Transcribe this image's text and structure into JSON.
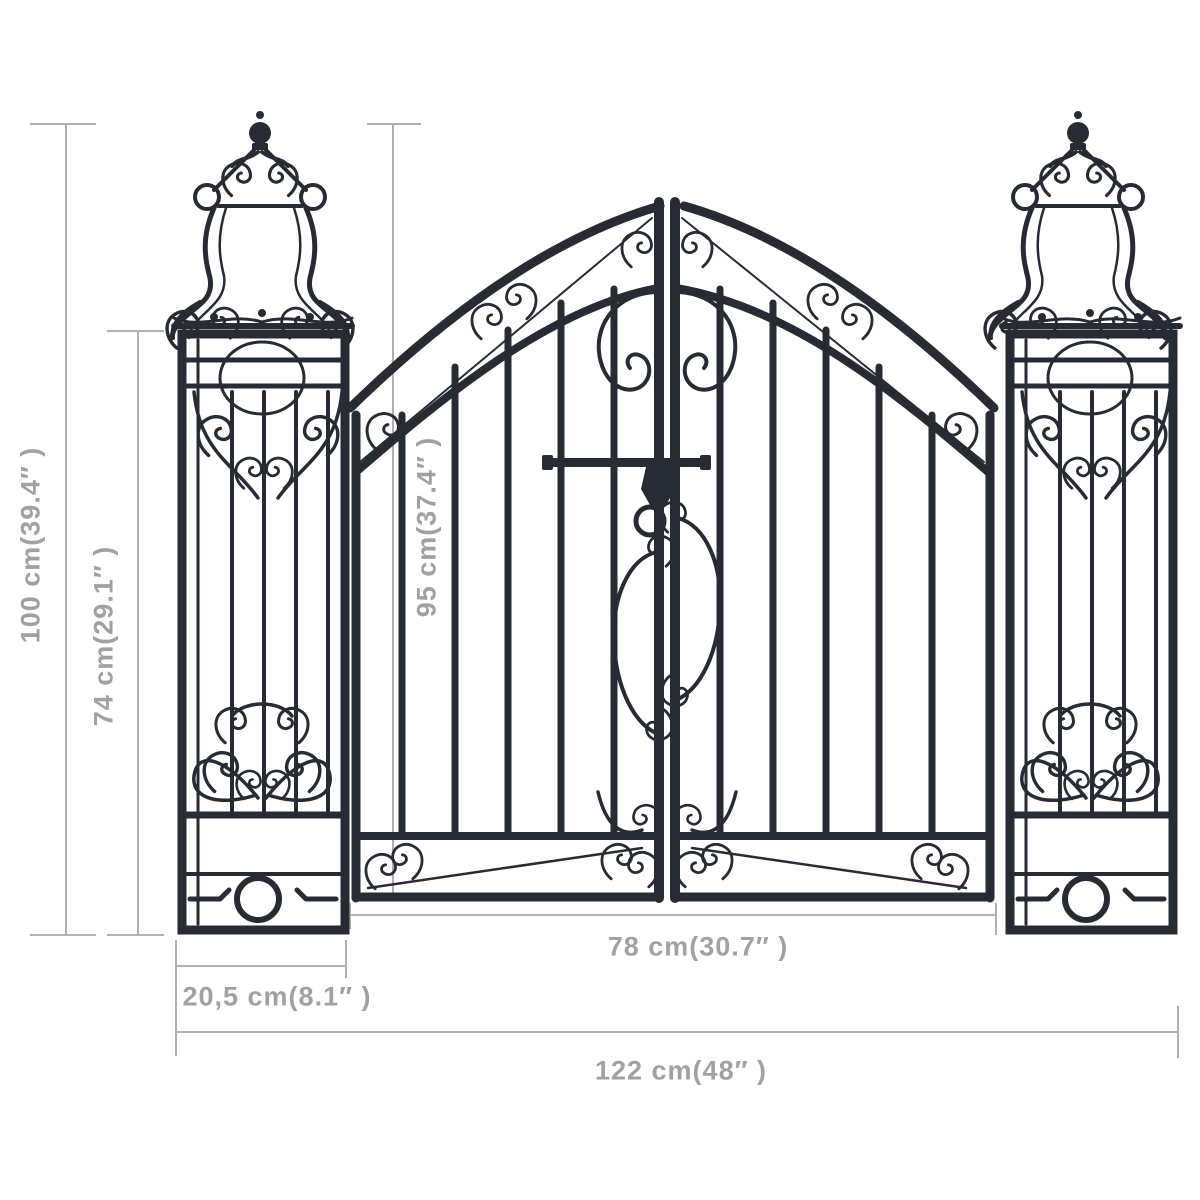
{
  "diagram": {
    "subject": "ornamental-garden-gate-with-pillars",
    "colors": {
      "gate": "#272b34",
      "dimension_lines": "#b0b0b0",
      "dimension_text": "#a1a1a1",
      "background": "#ffffff"
    },
    "dimensions": {
      "total_height": {
        "label": "100 cm(39.4″ )",
        "value_cm": 100,
        "value_in": 39.4,
        "orientation": "vertical"
      },
      "pillar_height": {
        "label": "74 cm(29.1″ )",
        "value_cm": 74,
        "value_in": 29.1,
        "orientation": "vertical"
      },
      "gate_leaf_height": {
        "label": "95 cm(37.4″ )",
        "value_cm": 95,
        "value_in": 37.4,
        "orientation": "vertical"
      },
      "gate_leaf_width": {
        "label": "78 cm(30.7″ )",
        "value_cm": 78,
        "value_in": 30.7,
        "orientation": "horizontal"
      },
      "pillar_width": {
        "label": "20,5 cm(8.1″ )",
        "value_cm": 20.5,
        "value_in": 8.1,
        "orientation": "horizontal"
      },
      "total_width": {
        "label": "122 cm(48″ )",
        "value_cm": 122,
        "value_in": 48,
        "orientation": "horizontal"
      }
    }
  }
}
